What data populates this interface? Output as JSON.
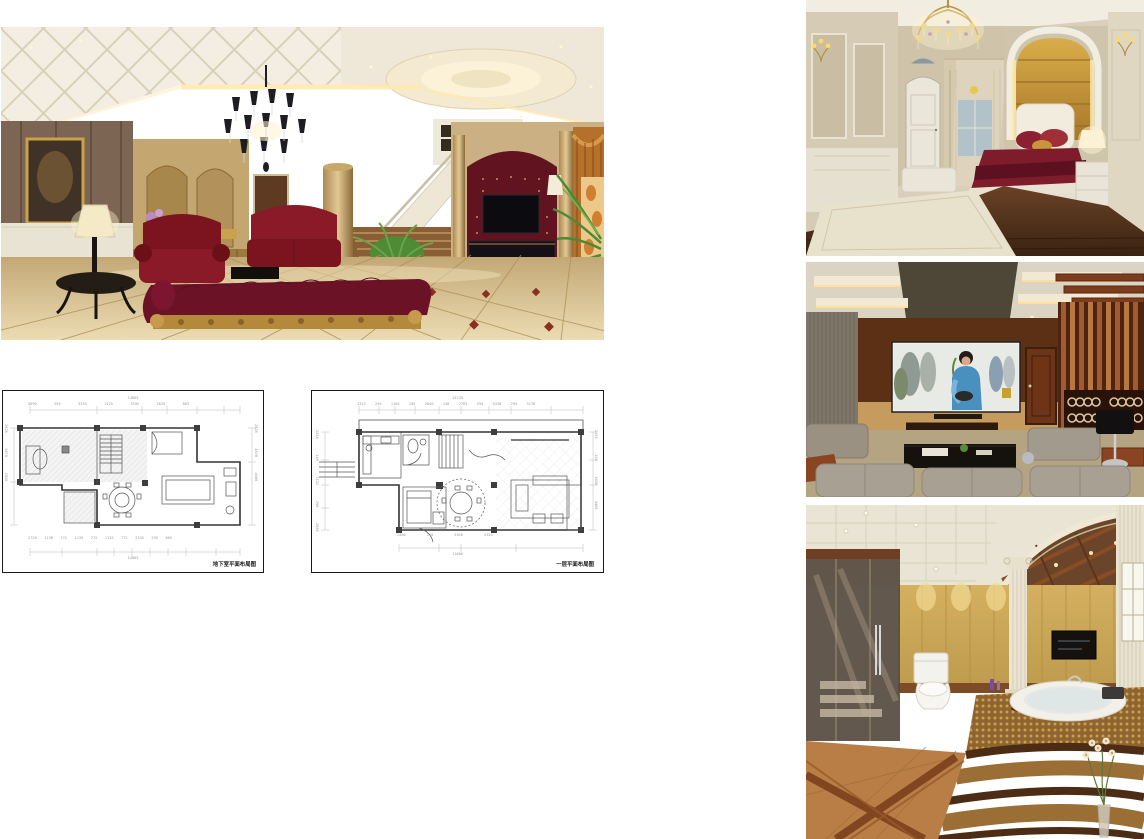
{
  "page": {
    "background": "#ffffff"
  },
  "renders": {
    "living_room": {
      "description": "European luxury living room render: white coffered ceiling with recessed oval cove, black crystal chandelier, brown marble wall with gilt-framed painting, cream table lamp on black side table, burgundy classical sofas and gold-carved chaise, marble column, staircase with white balustrade, red tufted TV wall with gold pilasters, orange damask curtain alcove and palm plant, beige marble tile floor"
    },
    "bedroom": {
      "description": "European bedroom render: gold crystal chandelier, cream panelled walls with gold sconces, white arched door, sheer curtained window, gold tufted headboard wall inside white arched moulding, burgundy bedding with white tufted headboard, white bench and nightstand with lamp, dark wood floor with cream rug"
    },
    "media_room": {
      "description": "Home cinema render: coffered ceiling with warm cove lighting, large projection screen showing a woman in blue, dark walnut wall, reddish wood door, rosewood slat feature wall with ring-decorated shelving, black table lamp, grey modular seating around black coffee table"
    },
    "bathroom": {
      "description": "Classical bathroom render: white tiled ceiling with downlights, mirrored arched alcove with wood joists, Corinthian columns, gold tiled walls with TV, glass shower enclosure, white toilet, raised round bathtub on curved mosaic and dark-marble steps, terracotta floor with dark diagonal inlay, dried flowers in a glass vase"
    }
  },
  "plans": {
    "basement": {
      "caption": "地下室平面布局图",
      "total_width": "14865",
      "dims_top": [
        "5890",
        "295",
        "3335",
        "1425",
        "3595",
        "2825",
        "865"
      ],
      "dims_bottom": [
        "2720",
        "1130",
        "772",
        "1135",
        "772",
        "1135",
        "772",
        "2135",
        "295",
        "865"
      ],
      "dims_left": [
        "2928",
        "6878",
        "2928"
      ],
      "dims_right": [
        "2928",
        "4678",
        "4508"
      ]
    },
    "first_floor": {
      "caption": "一层平面布局图",
      "total_width": "15239",
      "total_bottom": "11000",
      "dims_top": [
        "1313",
        "295",
        "1165",
        "295",
        "2640",
        "140",
        "2785",
        "295",
        "5430",
        "295",
        "3178"
      ],
      "dims_bottom": [
        "2406",
        "140",
        "3920",
        "5355"
      ],
      "dims_left": [
        "2248",
        "140",
        "1122",
        "298",
        "2986"
      ],
      "dims_right": [
        "2355",
        "140",
        "4458",
        "4408"
      ]
    }
  },
  "colors": {
    "burgundy": "#7a1724",
    "gold": "#b98d4f",
    "walnut": "#5f3317",
    "terracotta": "#c08a52"
  }
}
